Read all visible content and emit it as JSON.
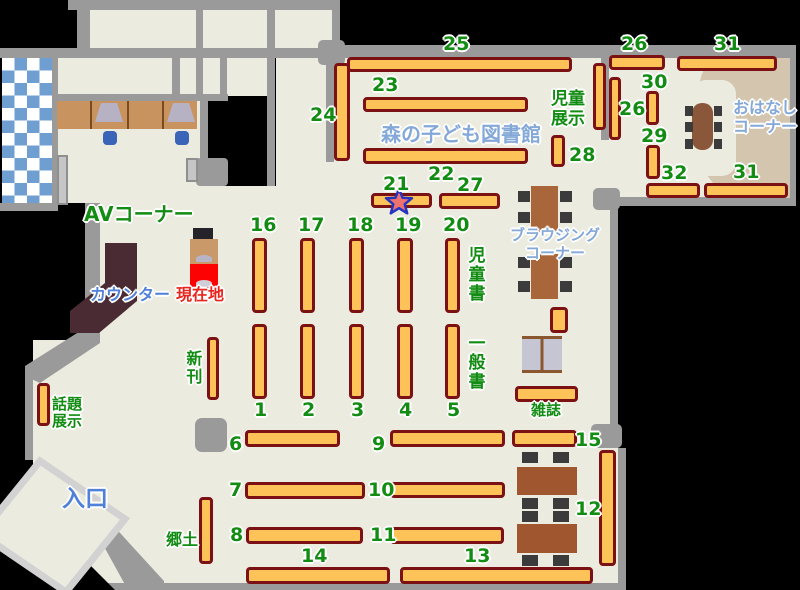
{
  "title": "森の子ども図書館",
  "labels": {
    "l1": "1",
    "l2": "2",
    "l3": "3",
    "l4": "4",
    "l5": "5",
    "l6": "6",
    "l7": "7",
    "l8": "8",
    "l9": "9",
    "l10": "10",
    "l11": "11",
    "l12": "12",
    "l13": "13",
    "l14": "14",
    "l15": "15",
    "l16": "16",
    "l17": "17",
    "l18": "18",
    "l19": "19",
    "l20": "20",
    "l21": "21",
    "l22": "22",
    "l23": "23",
    "l24": "24",
    "l25": "25",
    "l26a": "26",
    "l26b": "26",
    "l27": "27",
    "l28": "28",
    "l29": "29",
    "l30": "30",
    "l31a": "31",
    "l31b": "31",
    "l32": "32"
  },
  "areas": {
    "av": "AVコーナー",
    "counter": "カウンター",
    "current_location": "現在地",
    "new_books": "新刊",
    "topic_display": [
      "話題",
      "展示"
    ],
    "entrance": "入口",
    "local": "郷土",
    "magazines": "雑誌",
    "children_books": "児童書",
    "general_books": "一般書",
    "children_display": [
      "児童",
      "展示"
    ],
    "browsing_corner": [
      "ブラウジング",
      "コーナー"
    ],
    "story_corner": [
      "おはなし",
      "コーナー"
    ]
  },
  "colors": {
    "shelf": "#fdc359",
    "shelf_border": "#7c1113",
    "wall": "#9a9a9a",
    "floor": "#ebebdf",
    "label_green": "#128c12",
    "label_blue": "#4f81d9",
    "label_lightblue": "#84a8d8",
    "label_red": "#e8261f",
    "story_area_tan": "#d4c5ae",
    "table_brown": "#a9663b",
    "counter_brown": "#4a2b33",
    "checker_blue": "#6f9fd0",
    "star_red": "#f0726e",
    "star_outline": "#2633c0"
  }
}
